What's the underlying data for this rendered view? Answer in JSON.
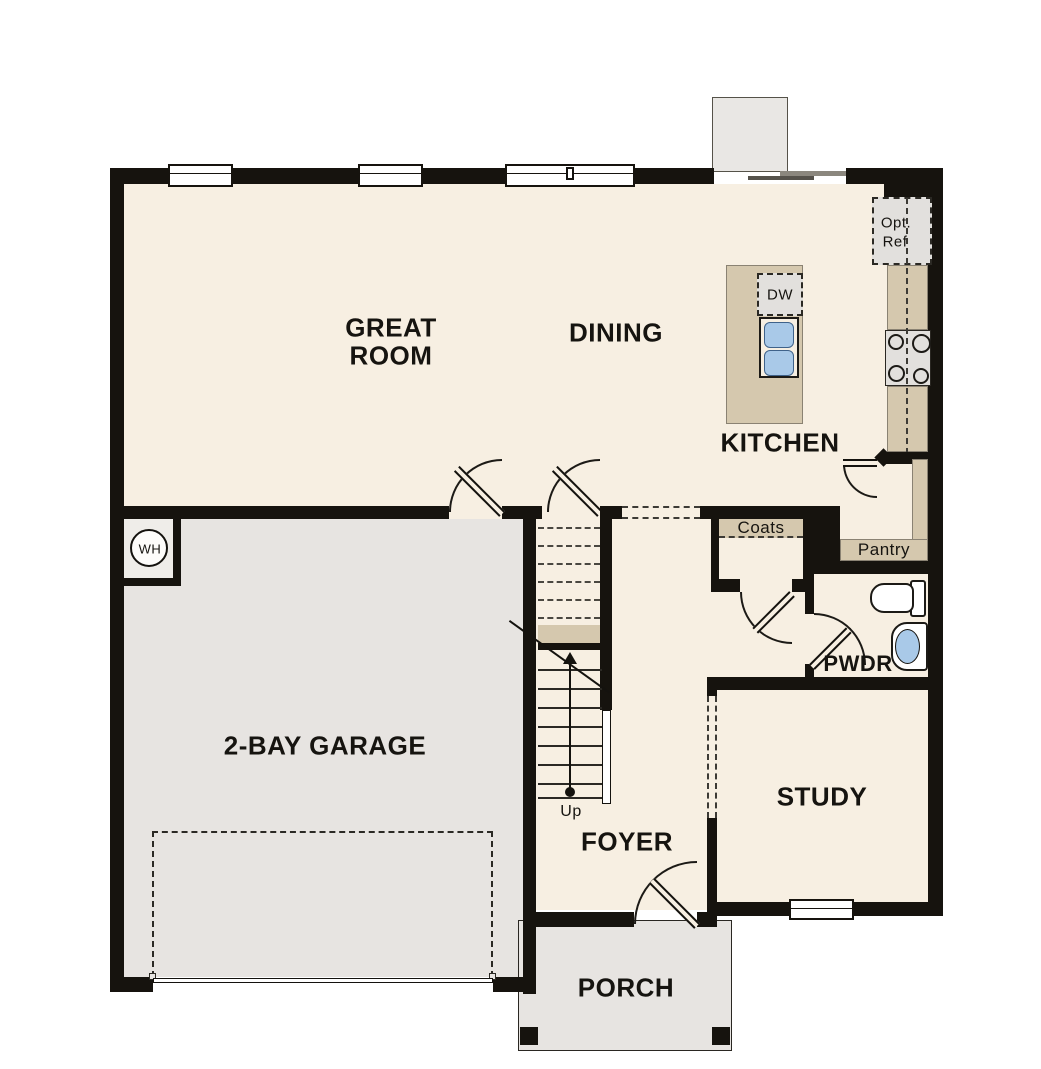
{
  "plan_title": "First Floor Plan",
  "colors": {
    "wall": "#16130e",
    "cream": "#f7efe2",
    "gray": "#e7e4e1",
    "tan": "#d5c8ae",
    "blue": "#a9c9e8",
    "fixture": "#e2e0dd"
  },
  "rooms": {
    "great_room_line1": "GREAT",
    "great_room_line2": "ROOM",
    "dining": "DINING",
    "kitchen": "KITCHEN",
    "garage": "2-BAY GARAGE",
    "foyer": "FOYER",
    "study": "STUDY",
    "powder": "PWDR",
    "porch": "PORCH"
  },
  "features": {
    "coats_closet": "Coats",
    "pantry": "Pantry",
    "water_heater": "WH",
    "stairs_direction": "Up",
    "optional_refrigerator_line1": "Opt.",
    "optional_refrigerator_line2": "Ref",
    "dishwasher": "DW"
  }
}
